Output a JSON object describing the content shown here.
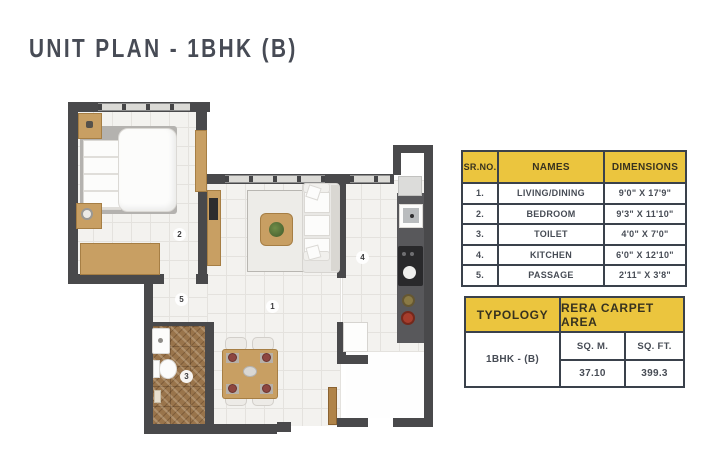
{
  "title": "UNIT PLAN - 1BHK (B)",
  "plan": {
    "room_labels": [
      {
        "num": "1",
        "room": "living-dining"
      },
      {
        "num": "2",
        "room": "bedroom"
      },
      {
        "num": "3",
        "room": "toilet"
      },
      {
        "num": "4",
        "room": "kitchen"
      },
      {
        "num": "5",
        "room": "passage"
      }
    ]
  },
  "rooms_table": {
    "headers": {
      "sr": "SR.NO.",
      "names": "NAMES",
      "dimensions": "DIMENSIONS"
    },
    "rows": [
      {
        "sr": "1.",
        "name": "LIVING/DINING",
        "dim": "9'0\" X 17'9\""
      },
      {
        "sr": "2.",
        "name": "BEDROOM",
        "dim": "9'3\" X 11'10\""
      },
      {
        "sr": "3.",
        "name": "TOILET",
        "dim": "4'0\" X 7'0\""
      },
      {
        "sr": "4.",
        "name": "KITCHEN",
        "dim": "6'0\" X 12'10\""
      },
      {
        "sr": "5.",
        "name": "PASSAGE",
        "dim": "2'11\" X 3'8\""
      }
    ]
  },
  "typology_table": {
    "typology_header": "TYPOLOGY",
    "area_header": "RERA CARPET AREA",
    "typology_value": "1BHK - (B)",
    "sqm_label": "SQ. M.",
    "sqft_label": "SQ. FT.",
    "sqm_value": "37.10",
    "sqft_value": "399.3"
  },
  "colors": {
    "accent_yellow": "#EBC53E",
    "wall_dark": "#49494B",
    "wood": "#C89F63",
    "table_border": "#3A414B",
    "toilet_floor": "#99744B"
  }
}
